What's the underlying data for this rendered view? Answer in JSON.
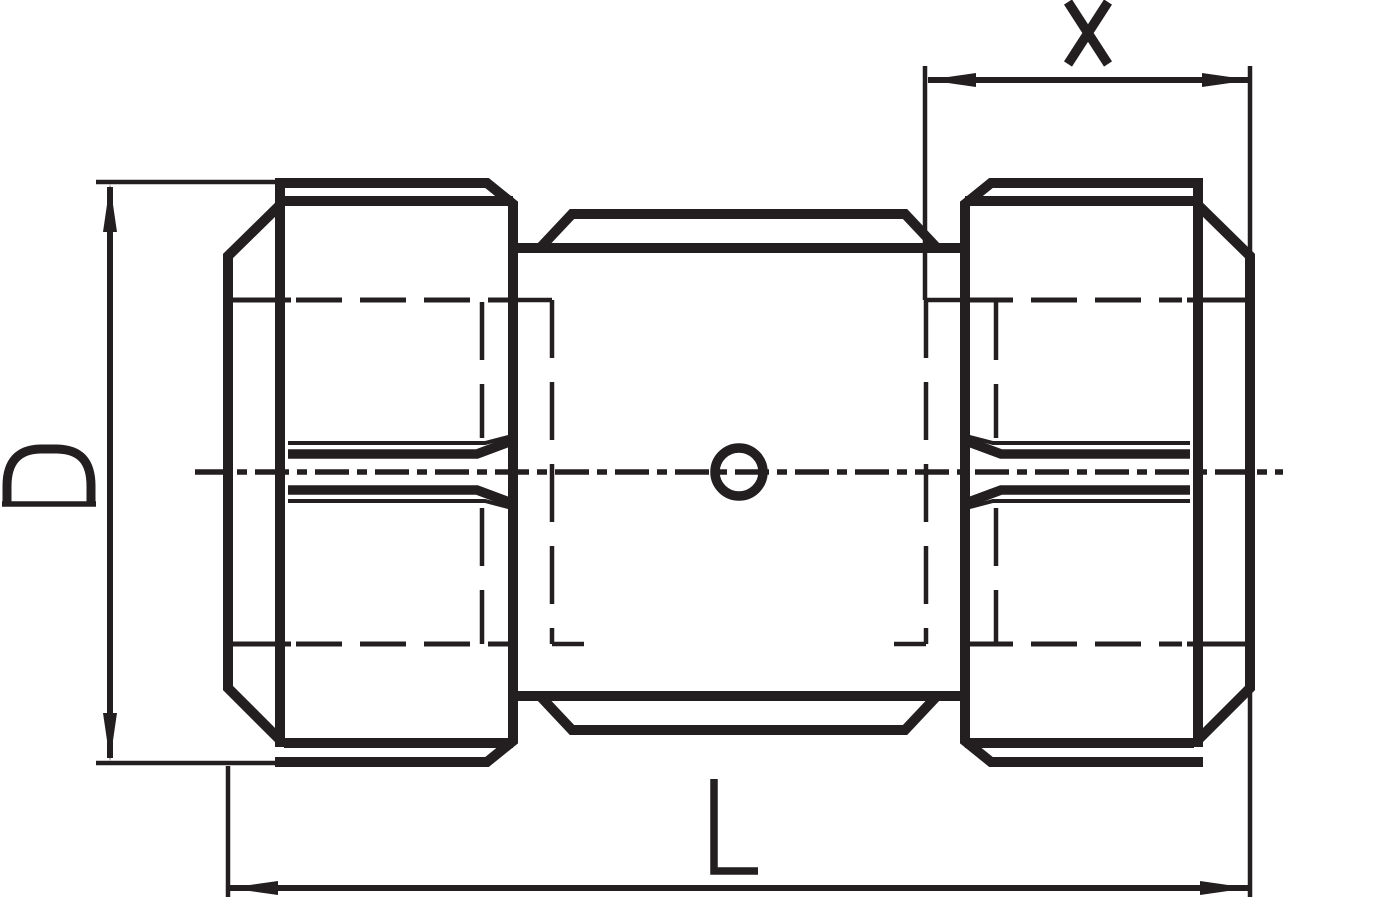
{
  "drawing": {
    "figure": "pipe-union-coupling-side-view",
    "colors": {
      "ink": "#231f20",
      "background": "#ffffff"
    },
    "parts": {
      "left_nut": "left coupling nut",
      "center_body": "center body",
      "right_nut": "right coupling nut",
      "center_hole": "center hole",
      "centerline": "horizontal centerline",
      "hidden_bore": "hidden internal bore"
    },
    "dimensions": {
      "d": {
        "label": "D",
        "orientation": "vertical",
        "position": "left"
      },
      "l": {
        "label": "L",
        "orientation": "horizontal",
        "position": "bottom"
      },
      "x": {
        "label": "X",
        "orientation": "horizontal",
        "position": "top-right"
      }
    }
  }
}
